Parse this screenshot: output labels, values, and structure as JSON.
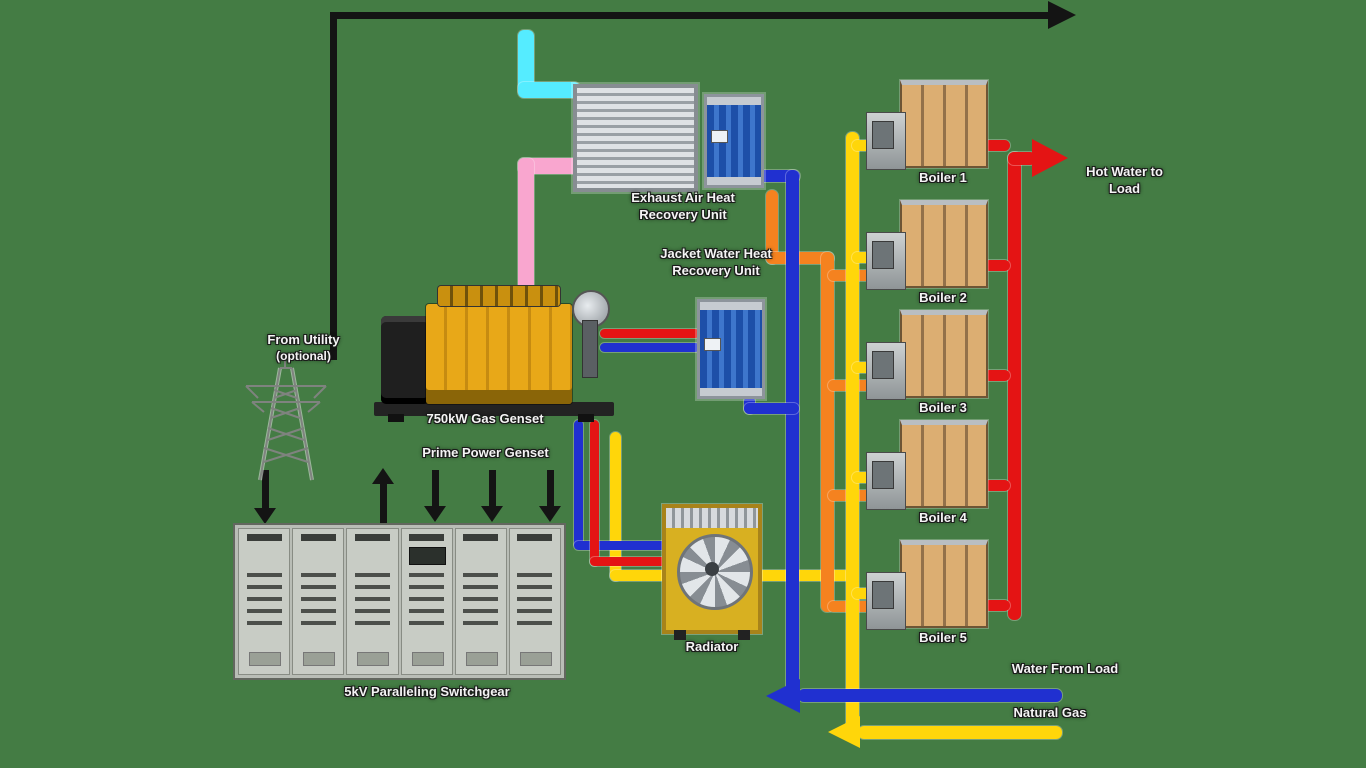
{
  "palette": {
    "background": "#447c44",
    "electric_line": "#141414",
    "hot_water_supply": "#e41414",
    "water_return": "#2030d0",
    "natural_gas": "#ffd60a",
    "preheat_loop": "#f5821f",
    "exhaust_inlet": "#55ecff",
    "exhaust_outlet": "#f9a6cf",
    "boiler_body": "#dcae72",
    "engine_yellow": "#e8a818"
  },
  "labels": {
    "utility_line1": "From Utility",
    "utility_line2": "(optional)",
    "genset_title": "750kW Gas Genset",
    "genset_subtitle": "Prime Power Genset",
    "exhaust_hx_line1": "Exhaust Air Heat",
    "exhaust_hx_line2": "Recovery Unit",
    "jacket_hx_line1": "Jacket Water Heat",
    "jacket_hx_line2": "Recovery Unit",
    "radiator": "Radiator",
    "switchgear": "5kV Paralleling Switchgear",
    "hot_water_line1": "Hot Water to",
    "hot_water_line2": "Load",
    "water_return": "Water From Load",
    "natural_gas": "Natural Gas"
  },
  "boilers": [
    {
      "label": "Boiler 1"
    },
    {
      "label": "Boiler 2"
    },
    {
      "label": "Boiler 3"
    },
    {
      "label": "Boiler 4"
    },
    {
      "label": "Boiler 5"
    }
  ]
}
